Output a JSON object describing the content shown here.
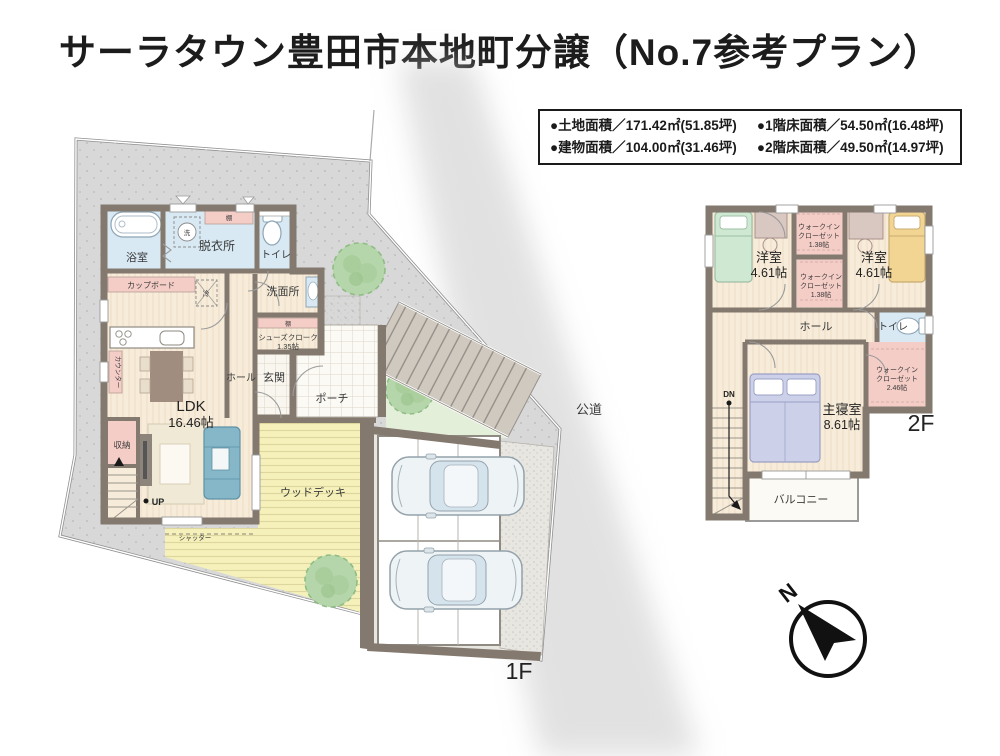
{
  "title": "サーラタウン豊田市本地町分譲（No.7参考プラン）",
  "info_box": {
    "items": [
      "●土地面積／171.42㎡(51.85坪)",
      "●1階床面積／54.50㎡(16.48坪)",
      "●建物面積／104.00㎡(31.46坪)",
      "●2階床面積／49.50㎡(14.97坪)"
    ]
  },
  "floor1": {
    "floor_label": "1F",
    "road": "公道",
    "rooms": {
      "bath": "浴室",
      "dressing": "脱衣所",
      "laundry": "洗",
      "shelf": "棚",
      "toilet": "トイレ",
      "washroom": "洗面所",
      "cupboard": "カップボード",
      "fridge": "冷",
      "shoes_closet": "シューズクローク",
      "shoes_closet_size": "1.35帖",
      "hall": "ホール",
      "entrance": "玄関",
      "porch": "ポーチ",
      "ldk": "LDK",
      "ldk_size": "16.46帖",
      "counter": "カウンター",
      "storage": "収納",
      "up": "UP",
      "shutter": "シャッター",
      "wood_deck": "ウッドデッキ"
    }
  },
  "floor2": {
    "floor_label": "2F",
    "rooms": {
      "room": "洋室",
      "room_size": "4.61帖",
      "wic_l1": "ウォークイン",
      "wic_l2": "クローゼット",
      "wic_small_size": "1.38帖",
      "wic_large_size": "2.46帖",
      "hall": "ホール",
      "toilet": "トイレ",
      "master": "主寝室",
      "master_size": "8.61帖",
      "dn": "DN",
      "balcony": "バルコニー"
    }
  },
  "compass": {
    "north": "N"
  },
  "colors": {
    "site": "#d8d8d8",
    "wall": "#84796f",
    "floor": "#f7ecd9",
    "wet": "#d8e9f4",
    "pink": "#f5cdc7",
    "deck": "#f6f1bb",
    "tree": "#b5d6aa",
    "car": "#eef3f6"
  }
}
